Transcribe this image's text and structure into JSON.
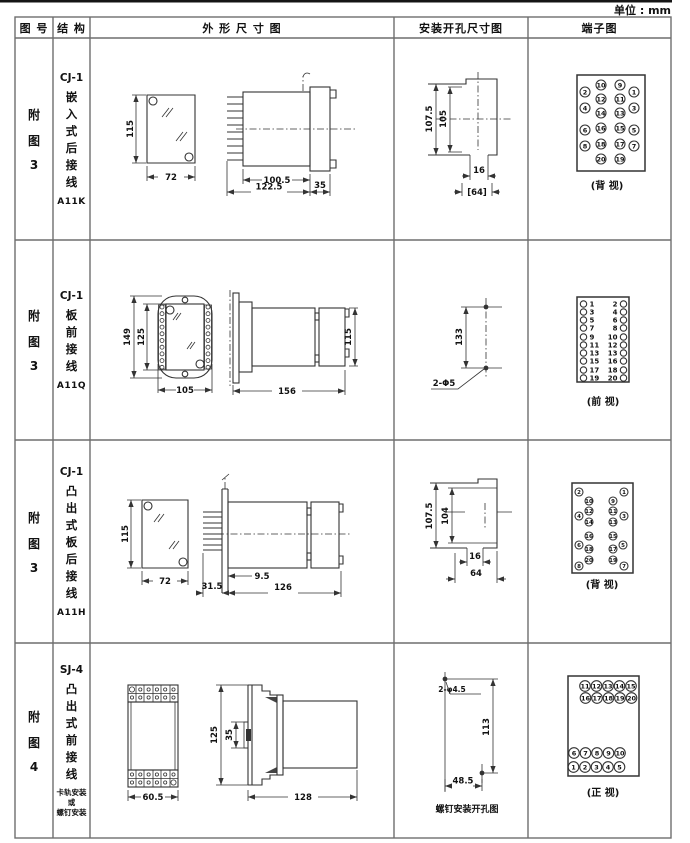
{
  "unit_label": "单位 : mm",
  "headers": [
    "图 号",
    "结 构",
    "外 形 尺 寸 图",
    "安装开孔尺寸图",
    "端子图"
  ],
  "rows": [
    {
      "fig": [
        "附",
        "图",
        "3"
      ],
      "model": "CJ-1",
      "desc": [
        "嵌",
        "入",
        "式",
        "后",
        "接",
        "线"
      ],
      "code": "A11K",
      "outline": {
        "front_h": "115",
        "front_w": "72",
        "side_a": "100.5",
        "side_b": "122.5",
        "side_c": "35"
      },
      "mount": {
        "v1": "107.5",
        "v2": "105",
        "h1": "16",
        "h2": "[64]"
      },
      "terminal": {
        "caption": "(背 视)",
        "pins": [
          {
            "n": "10",
            "x": 601,
            "y": 85
          },
          {
            "n": "9",
            "x": 620,
            "y": 85
          },
          {
            "n": "2",
            "x": 585,
            "y": 92
          },
          {
            "n": "1",
            "x": 634,
            "y": 92
          },
          {
            "n": "12",
            "x": 601,
            "y": 99
          },
          {
            "n": "11",
            "x": 620,
            "y": 99
          },
          {
            "n": "4",
            "x": 585,
            "y": 108
          },
          {
            "n": "3",
            "x": 634,
            "y": 108
          },
          {
            "n": "14",
            "x": 601,
            "y": 113
          },
          {
            "n": "13",
            "x": 620,
            "y": 113
          },
          {
            "n": "16",
            "x": 601,
            "y": 128
          },
          {
            "n": "15",
            "x": 620,
            "y": 128
          },
          {
            "n": "6",
            "x": 585,
            "y": 130
          },
          {
            "n": "5",
            "x": 634,
            "y": 130
          },
          {
            "n": "18",
            "x": 601,
            "y": 144
          },
          {
            "n": "17",
            "x": 620,
            "y": 144
          },
          {
            "n": "8",
            "x": 585,
            "y": 146
          },
          {
            "n": "7",
            "x": 634,
            "y": 146
          },
          {
            "n": "20",
            "x": 601,
            "y": 159
          },
          {
            "n": "19",
            "x": 620,
            "y": 159
          }
        ]
      }
    },
    {
      "fig": [
        "附",
        "图",
        "3"
      ],
      "model": "CJ-1",
      "desc": [
        "板",
        "前",
        "接",
        "线"
      ],
      "code": "A11Q",
      "outline": {
        "front_h1": "149",
        "front_h2": "125",
        "front_w": "105",
        "side_len": "156",
        "side_h": "115"
      },
      "mount": {
        "v": "133",
        "label": "2-Φ5"
      },
      "terminal": {
        "caption": "(前 视)",
        "pins": [
          {
            "x": 583.5,
            "y": 304
          },
          {
            "t": "1",
            "x": 589.5,
            "y": 304,
            "a": "start"
          },
          {
            "t": "2",
            "x": 617.5,
            "y": 304,
            "a": "end"
          },
          {
            "x": 623.5,
            "y": 304
          },
          {
            "x": 583.5,
            "y": 312
          },
          {
            "t": "3",
            "x": 589.5,
            "y": 312,
            "a": "start"
          },
          {
            "t": "4",
            "x": 617.5,
            "y": 312,
            "a": "end"
          },
          {
            "x": 623.5,
            "y": 312
          },
          {
            "x": 583.5,
            "y": 320
          },
          {
            "t": "5",
            "x": 589.5,
            "y": 320,
            "a": "start"
          },
          {
            "t": "6",
            "x": 617.5,
            "y": 320,
            "a": "end"
          },
          {
            "x": 623.5,
            "y": 320
          },
          {
            "x": 583.5,
            "y": 328
          },
          {
            "t": "7",
            "x": 589.5,
            "y": 328,
            "a": "start"
          },
          {
            "t": "8",
            "x": 617.5,
            "y": 328,
            "a": "end"
          },
          {
            "x": 623.5,
            "y": 328
          },
          {
            "x": 583.5,
            "y": 337
          },
          {
            "t": "9",
            "x": 589.5,
            "y": 337,
            "a": "start"
          },
          {
            "t": "10",
            "x": 617.5,
            "y": 337,
            "a": "end"
          },
          {
            "x": 623.5,
            "y": 337
          },
          {
            "x": 583.5,
            "y": 345
          },
          {
            "t": "11",
            "x": 589.5,
            "y": 345,
            "a": "start"
          },
          {
            "t": "12",
            "x": 617.5,
            "y": 345,
            "a": "end"
          },
          {
            "x": 623.5,
            "y": 345
          },
          {
            "x": 583.5,
            "y": 353
          },
          {
            "t": "13",
            "x": 589.5,
            "y": 353,
            "a": "start"
          },
          {
            "t": "13",
            "x": 617.5,
            "y": 353,
            "a": "end"
          },
          {
            "x": 623.5,
            "y": 353
          },
          {
            "x": 583.5,
            "y": 361
          },
          {
            "t": "15",
            "x": 589.5,
            "y": 361,
            "a": "start"
          },
          {
            "t": "16",
            "x": 617.5,
            "y": 361,
            "a": "end"
          },
          {
            "x": 623.5,
            "y": 361
          },
          {
            "x": 583.5,
            "y": 370
          },
          {
            "t": "17",
            "x": 589.5,
            "y": 370,
            "a": "start"
          },
          {
            "t": "18",
            "x": 617.5,
            "y": 370,
            "a": "end"
          },
          {
            "x": 623.5,
            "y": 370
          },
          {
            "x": 583.5,
            "y": 378
          },
          {
            "t": "19",
            "x": 589.5,
            "y": 378,
            "a": "start"
          },
          {
            "t": "20",
            "x": 617.5,
            "y": 378,
            "a": "end"
          },
          {
            "x": 623.5,
            "y": 378
          }
        ]
      }
    },
    {
      "fig": [
        "附",
        "图",
        "3"
      ],
      "model": "CJ-1",
      "desc": [
        "凸",
        "出",
        "式",
        "板",
        "后",
        "接",
        "线"
      ],
      "code": "A11H",
      "outline": {
        "front_h": "115",
        "front_w": "72",
        "side_a": "31.5",
        "side_b": "9.5",
        "side_c": "126"
      },
      "mount": {
        "v1": "107.5",
        "v2": "104",
        "h1": "16",
        "h2": "64"
      },
      "terminal": {
        "caption": "(背 视)",
        "pins": [
          {
            "n": "2",
            "x": 579,
            "y": 492
          },
          {
            "n": "1",
            "x": 624,
            "y": 492
          },
          {
            "n": "10",
            "x": 589,
            "y": 501
          },
          {
            "n": "9",
            "x": 613,
            "y": 501
          },
          {
            "n": "12",
            "x": 589,
            "y": 511
          },
          {
            "n": "11",
            "x": 613,
            "y": 511
          },
          {
            "n": "4",
            "x": 579,
            "y": 516
          },
          {
            "n": "3",
            "x": 624,
            "y": 516
          },
          {
            "n": "14",
            "x": 589,
            "y": 522
          },
          {
            "n": "13",
            "x": 613,
            "y": 522
          },
          {
            "n": "16",
            "x": 589,
            "y": 536
          },
          {
            "n": "15",
            "x": 613,
            "y": 536
          },
          {
            "n": "6",
            "x": 579,
            "y": 545
          },
          {
            "n": "5",
            "x": 623,
            "y": 545
          },
          {
            "n": "18",
            "x": 589,
            "y": 549
          },
          {
            "n": "17",
            "x": 613,
            "y": 549
          },
          {
            "n": "20",
            "x": 589,
            "y": 560
          },
          {
            "n": "19",
            "x": 613,
            "y": 560
          },
          {
            "n": "8",
            "x": 579,
            "y": 566
          },
          {
            "n": "7",
            "x": 624,
            "y": 566
          }
        ]
      }
    },
    {
      "fig": [
        "附",
        "图",
        "4"
      ],
      "model": "SJ-4",
      "desc": [
        "凸",
        "出",
        "式",
        "前",
        "接",
        "线"
      ],
      "note": [
        "卡轨安装",
        "或",
        "螺钉安装"
      ],
      "outline": {
        "front_w": "60.5",
        "side_h": "125",
        "side_mid": "35",
        "side_len": "128"
      },
      "mount": {
        "label": "2-φ4.5",
        "v": "113",
        "h": "48.5",
        "caption": "螺钉安装开孔图"
      },
      "terminal": {
        "caption": "(正 视)",
        "pins": [
          {
            "n": "11",
            "x": 585,
            "y": 686
          },
          {
            "n": "12",
            "x": 596.5,
            "y": 686
          },
          {
            "n": "13",
            "x": 608,
            "y": 686
          },
          {
            "n": "14",
            "x": 619.5,
            "y": 686
          },
          {
            "n": "15",
            "x": 631,
            "y": 686
          },
          {
            "n": "16",
            "x": 585.5,
            "y": 698
          },
          {
            "n": "17",
            "x": 597,
            "y": 698
          },
          {
            "n": "18",
            "x": 608.5,
            "y": 698
          },
          {
            "n": "19",
            "x": 620,
            "y": 698
          },
          {
            "n": "20",
            "x": 631.5,
            "y": 698
          },
          {
            "n": "6",
            "x": 574,
            "y": 753
          },
          {
            "n": "7",
            "x": 585.5,
            "y": 753
          },
          {
            "n": "8",
            "x": 597,
            "y": 753
          },
          {
            "n": "9",
            "x": 608.5,
            "y": 753
          },
          {
            "n": "10",
            "x": 620,
            "y": 753
          },
          {
            "n": "1",
            "x": 573.5,
            "y": 767
          },
          {
            "n": "2",
            "x": 585,
            "y": 767
          },
          {
            "n": "3",
            "x": 596.5,
            "y": 767
          },
          {
            "n": "4",
            "x": 608,
            "y": 767
          },
          {
            "n": "5",
            "x": 619.5,
            "y": 767
          }
        ]
      }
    }
  ]
}
